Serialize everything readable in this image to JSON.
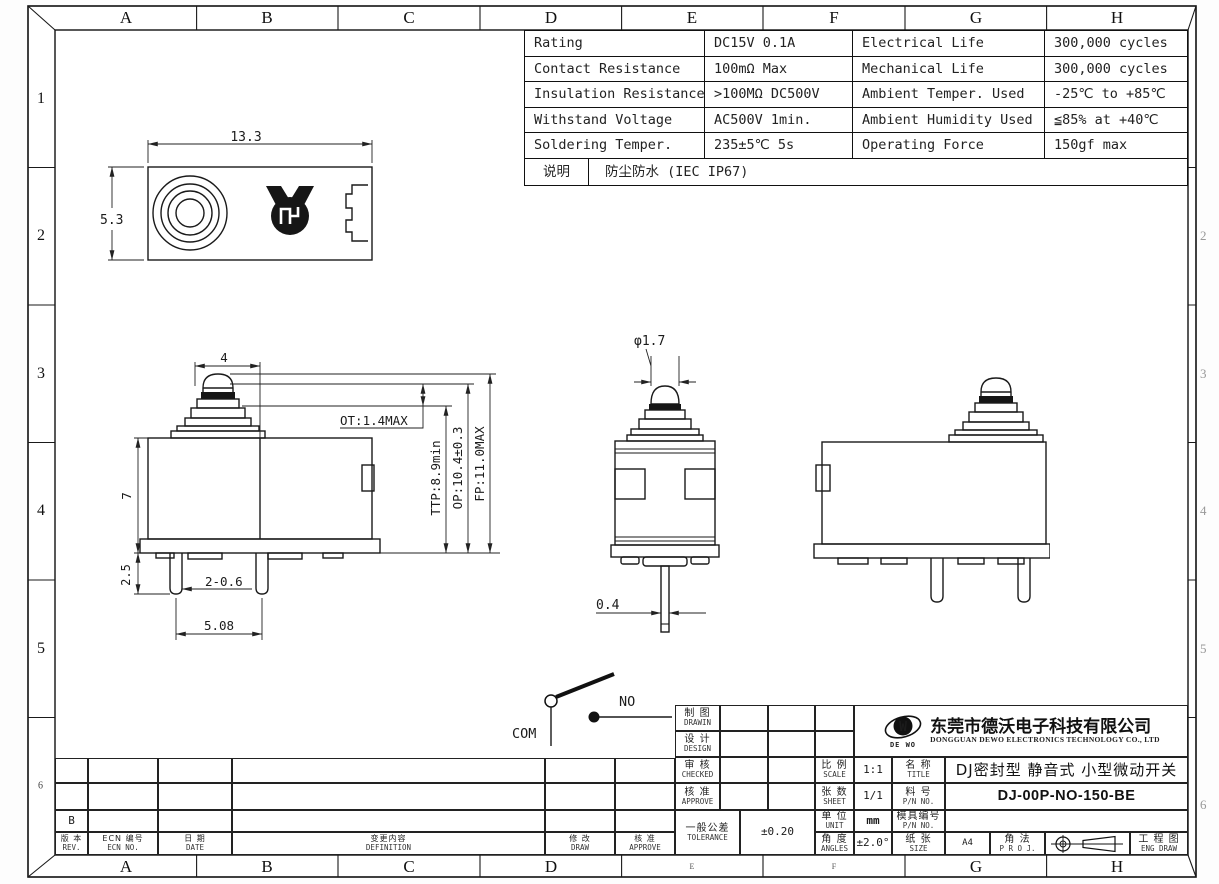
{
  "frame": {
    "columns": [
      "A",
      "B",
      "C",
      "D",
      "E",
      "F",
      "G",
      "H"
    ],
    "rows": [
      "1",
      "2",
      "3",
      "4",
      "5",
      "6"
    ]
  },
  "spec_table": {
    "rows": [
      [
        "Rating",
        "DC15V 0.1A",
        "Electrical Life",
        "300,000 cycles"
      ],
      [
        "Contact Resistance",
        "100mΩ Max",
        "Mechanical Life",
        "300,000 cycles"
      ],
      [
        "Insulation Resistance",
        ">100MΩ DC500V",
        "Ambient Temper. Used",
        "-25℃ to +85℃"
      ],
      [
        "Withstand Voltage",
        "AC500V  1min.",
        "Ambient Humidity Used",
        "≦85% at +40℃"
      ],
      [
        "Soldering Temper.",
        "235±5℃ 5s",
        "Operating Force",
        "150gf max"
      ]
    ],
    "note_label": "说明",
    "note_value": "防尘防水 (IEC IP67)"
  },
  "dimensions": {
    "top_view": {
      "width": "13.3",
      "height": "5.3"
    },
    "front_view": {
      "plunger_width": "4",
      "body_height": "7",
      "pin_exposed": "2.5",
      "pin_size": "2-0.6",
      "pin_pitch": "5.08",
      "ot": "OT:1.4MAX",
      "ttp": "TTP:8.9min",
      "op": "OP:10.4±0.3",
      "fp": "FP:11.0MAX"
    },
    "side_view": {
      "plunger_dia": "φ1.7",
      "pin_thickness": "0.4"
    }
  },
  "circuit": {
    "com_label": "COM",
    "no_label": "NO"
  },
  "revision_table": {
    "rev_value": "B",
    "rev_cn": "版 本",
    "rev_en": "REV.",
    "ecn_cn": "ECN 编号",
    "ecn_en": "ECN NO.",
    "date_cn": "日  期",
    "date_en": "DATE",
    "definition_cn": "变更内容",
    "definition_en": "DEFINITION",
    "draw_cn": "修  改",
    "draw_en": "DRAW",
    "approve_cn": "核  准",
    "approve_en": "APPROVE"
  },
  "title_block": {
    "drawn_cn": "制 图",
    "drawn_en": "DRAWIN",
    "design_cn": "设 计",
    "design_en": "DESIGN",
    "checked_cn": "审 核",
    "checked_en": "CHECKED",
    "approve_cn": "核 准",
    "approve_en": "APPROVE",
    "tolerance_cn": "一般公差",
    "tolerance_en": "TOLERANCE",
    "tolerance_value": "±0.20",
    "scale_cn": "比 例",
    "scale_en": "SCALE",
    "scale_value": "1:1",
    "sheet_cn": "张 数",
    "sheet_en": "SHEET",
    "sheet_value": "1/1",
    "unit_cn": "单 位",
    "unit_en": "UNIT",
    "unit_value": "mm",
    "angles_cn": "角 度",
    "angles_en": "ANGLES",
    "angles_value": "±2.0°",
    "title_cn": "名 称",
    "title_en": "TITLE",
    "title_value": "DJ密封型 静音式 小型微动开关",
    "pn_cn": "料 号",
    "pn_en": "P/N NO.",
    "pn_value": "DJ-00P-NO-150-BE",
    "mold_cn": "模具编号",
    "mold_en": "P/N NO.",
    "size_cn": "纸 张",
    "size_en": "SIZE",
    "size_value": "A4",
    "proj_cn": "角 法",
    "proj_en": "P R O J.",
    "engdraw_cn": "工 程 图",
    "engdraw_en": "ENG DRAW",
    "company_cn": "东莞市德沃电子科技有限公司",
    "company_en": "DONGGUAN DEWO ELECTRONICS TECHNOLOGY CO., LTD",
    "logo_text": "DE WO",
    "logo_letter": "W"
  }
}
